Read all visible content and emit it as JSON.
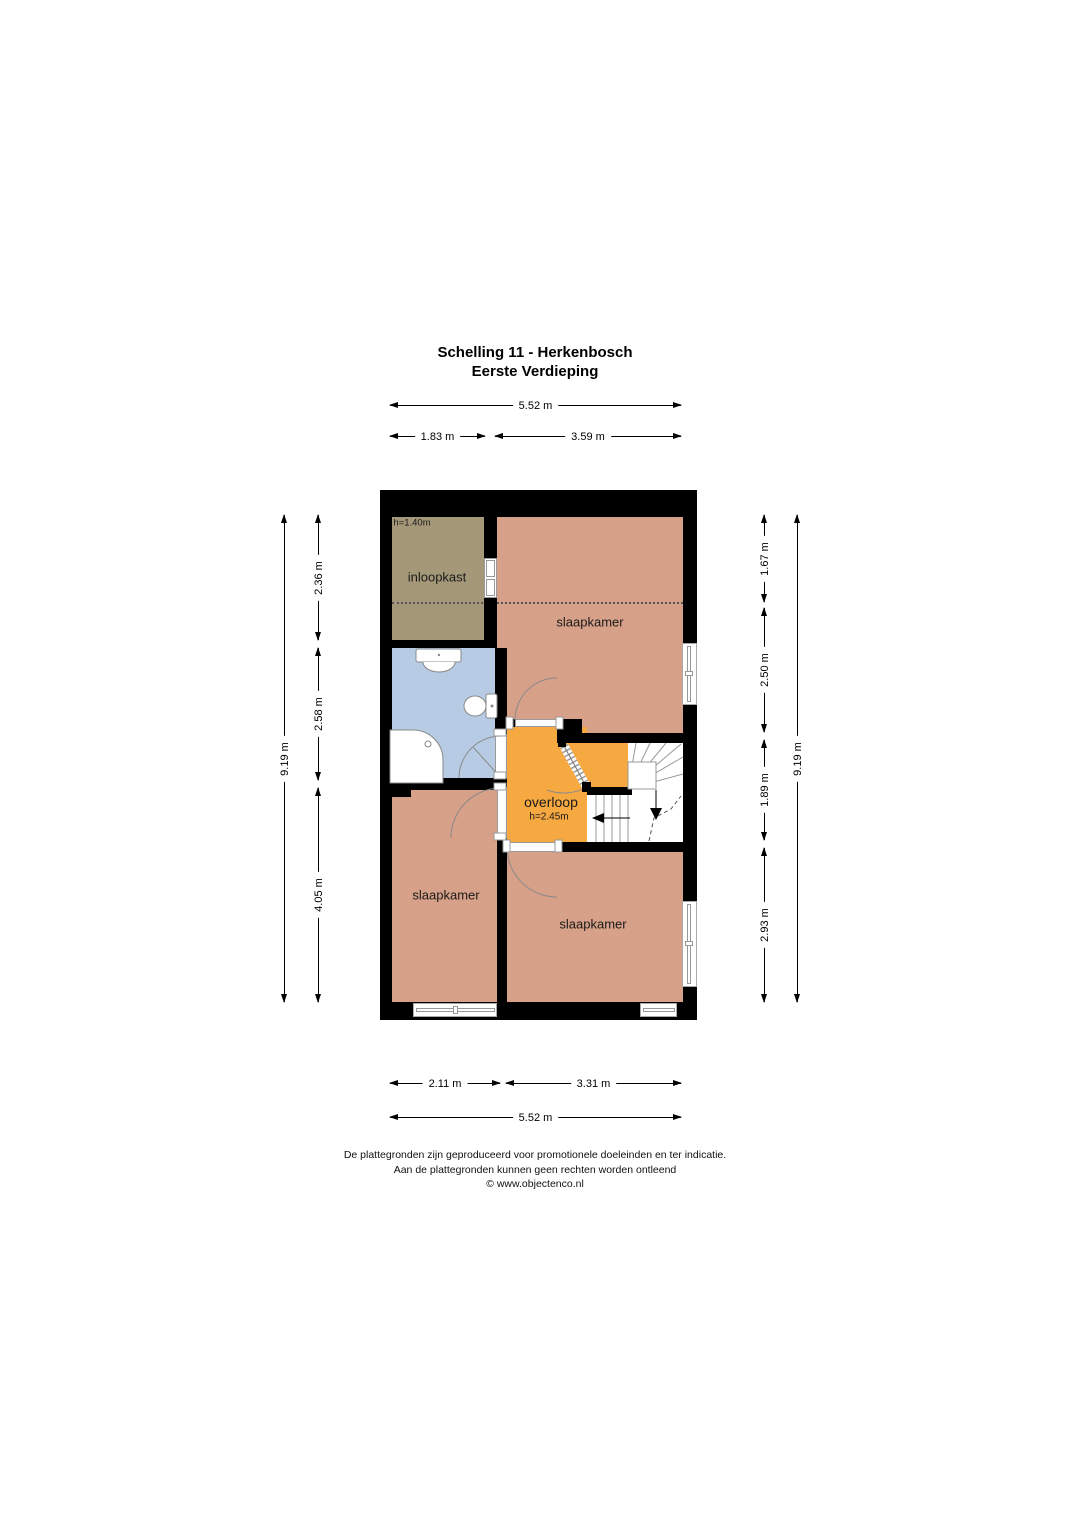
{
  "title": {
    "line1": "Schelling 11 - Herkenbosch",
    "line2": "Eerste Verdieping"
  },
  "rooms": {
    "inloopkast": "inloopkast",
    "inloopkast_height": "h=1.40m",
    "slaapkamer_top": "slaapkamer",
    "slaapkamer_left": "slaapkamer",
    "slaapkamer_right": "slaapkamer",
    "overloop": "overloop",
    "overloop_height": "h=2.45m"
  },
  "dimensions": {
    "top_total": "5.52 m",
    "top_left": "1.83 m",
    "top_right": "3.59 m",
    "bottom_left": "2.11 m",
    "bottom_right": "3.31 m",
    "bottom_total": "5.52 m",
    "left_total": "9.19 m",
    "left_seg1": "2.36 m",
    "left_seg2": "2.58 m",
    "left_seg3": "4.05 m",
    "right_seg1": "1.67 m",
    "right_seg2": "2.50 m",
    "right_seg3": "1.89 m",
    "right_seg4": "2.93 m",
    "right_total": "9.19 m"
  },
  "footer": {
    "line1": "De plattegronden zijn geproduceerd voor promotionele doeleinden en ter indicatie.",
    "line2": "Aan de plattegronden kunnen geen rechten worden ontleend",
    "line3": "© www.objectenco.nl"
  },
  "colors": {
    "wall": "#000000",
    "bedroom": "#d7a088",
    "closet": "#a49878",
    "bathroom": "#b7cce4",
    "landing": "#f6a941",
    "door_line": "#9a9a9a"
  }
}
